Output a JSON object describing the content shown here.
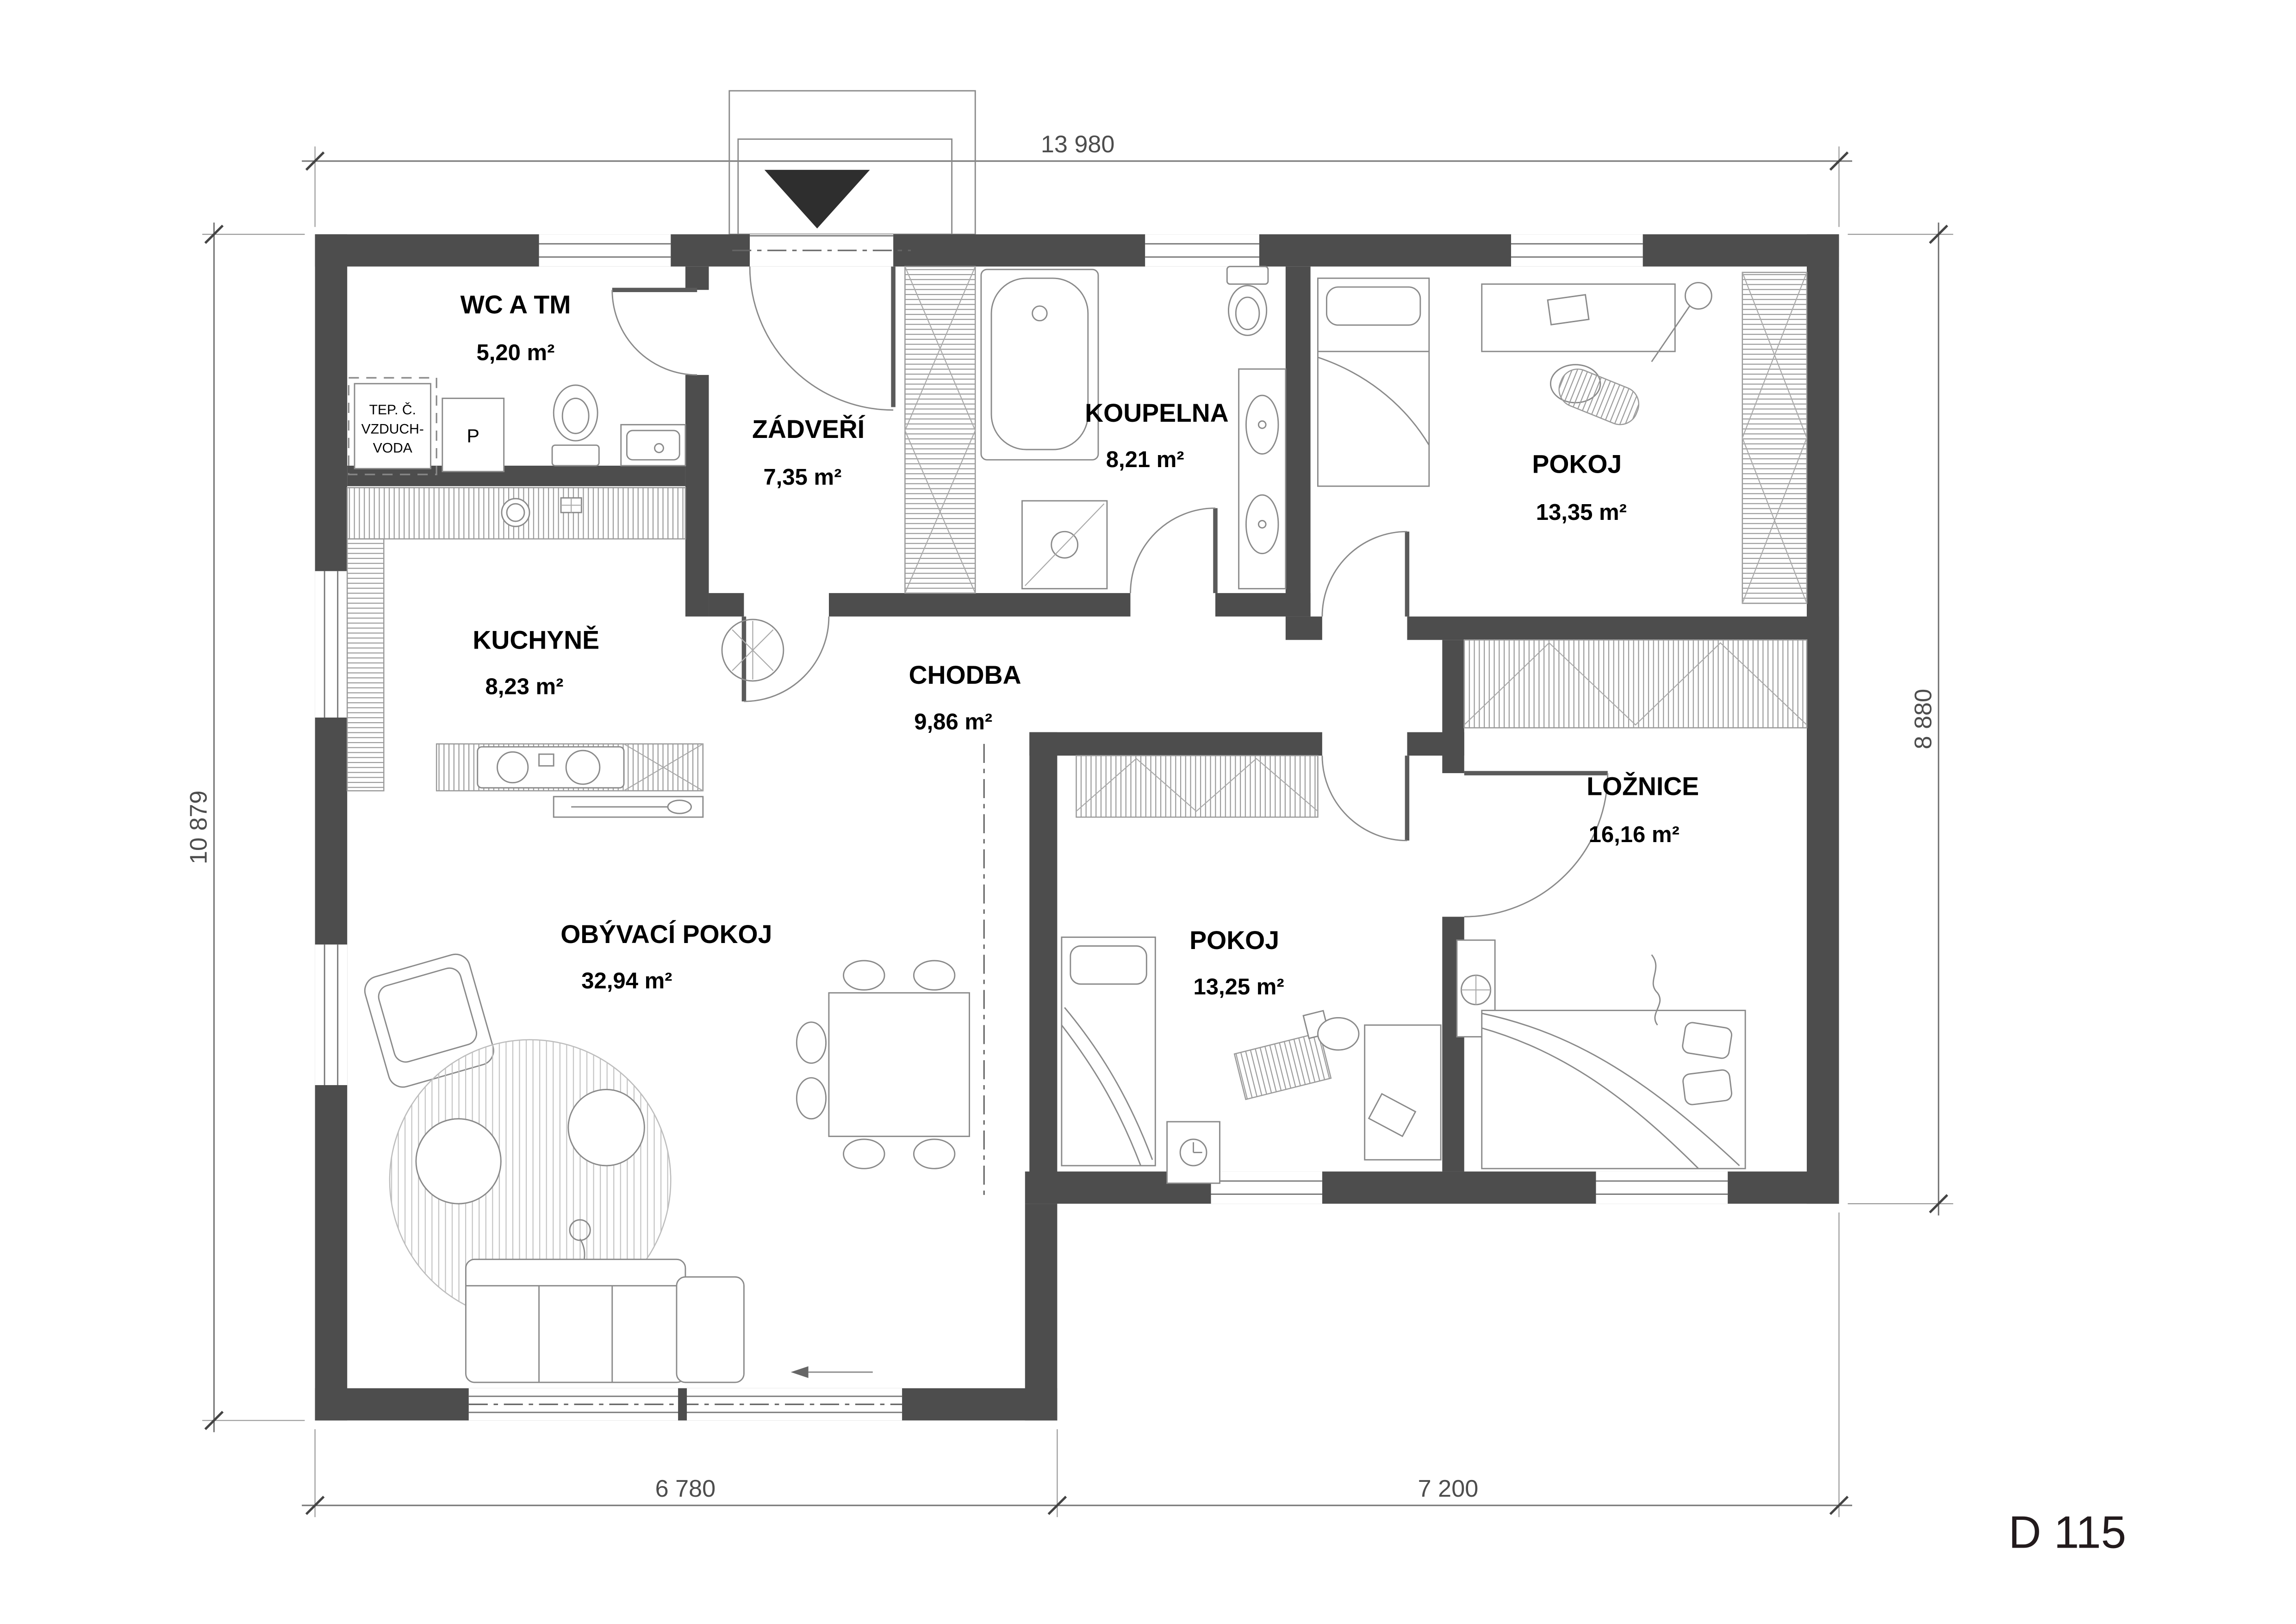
{
  "plan_code": "D 115",
  "rooms": {
    "wc": {
      "name": "WC A TM",
      "area": "5,20 m²"
    },
    "zadveri": {
      "name": "ZÁDVEŘÍ",
      "area": "7,35 m²"
    },
    "koupelna": {
      "name": "KOUPELNA",
      "area": "8,21 m²"
    },
    "pokoj1": {
      "name": "POKOJ",
      "area": "13,35 m²"
    },
    "kuchyne": {
      "name": "KUCHYNĚ",
      "area": "8,23 m²"
    },
    "chodba": {
      "name": "CHODBA",
      "area": "9,86 m²"
    },
    "loznice": {
      "name": "LOŽNICE",
      "area": "16,16 m²"
    },
    "obyvaci": {
      "name": "OBÝVACÍ POKOJ",
      "area": "32,94 m²"
    },
    "pokoj2": {
      "name": "POKOJ",
      "area": "13,25 m²"
    }
  },
  "labels": {
    "heat_pump": [
      "TEP. Č.",
      "VZDUCH-",
      "VODA"
    ],
    "pantry": "P"
  },
  "dimensions": {
    "top": "13 980",
    "left": "10 879",
    "right": "8 880",
    "bottom_left": "6 780",
    "bottom_right": "7 200"
  },
  "colors": {
    "wall": "#4d4d4d",
    "line": "#8a8a8a",
    "dim": "#4d4d4d",
    "accent": "#2e2e2e"
  }
}
